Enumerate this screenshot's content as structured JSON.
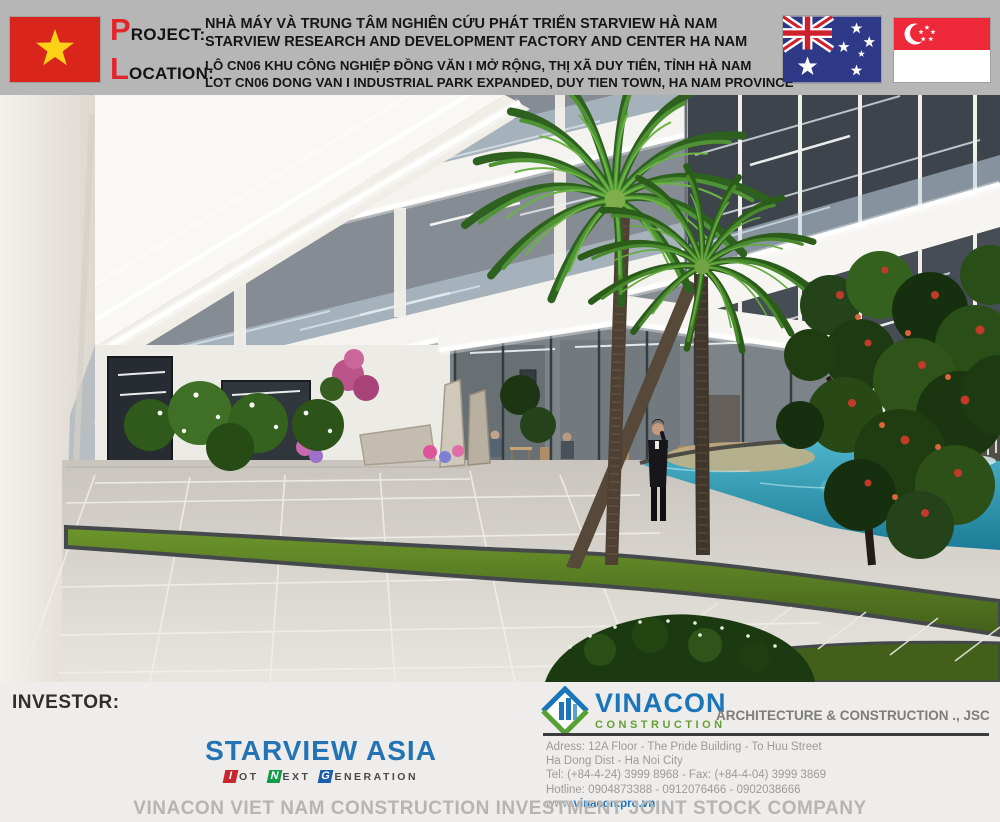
{
  "header": {
    "project": {
      "initial": "P",
      "rest": "ROJECT:",
      "line_vi": "NHÀ MÁY VÀ TRUNG TÂM NGHIÊN CỨU PHÁT TRIỂN STARVIEW HÀ NAM",
      "line_en": "STARVIEW RESEARCH AND DEVELOPMENT FACTORY AND CENTER HA NAM"
    },
    "location": {
      "initial": "L",
      "rest": "OCATION:",
      "line_vi": "LÔ CN06 KHU CÔNG NGHIỆP ĐỒNG VĂN I MỞ RỘNG, THỊ XÃ DUY TIÊN, TỈNH HÀ NAM",
      "line_en": "LOT CN06 DONG VAN I INDUSTRIAL PARK EXPANDED, DUY TIEN TOWN, HA NAM PROVINCE"
    },
    "flags": [
      "vietnam",
      "australia",
      "singapore"
    ]
  },
  "footer": {
    "investor_label": "INVESTOR:",
    "starview": {
      "name": "STARVIEW ASIA",
      "tagline": [
        {
          "initial": "I",
          "rest": "OT"
        },
        {
          "initial": "N",
          "rest": "EXT"
        },
        {
          "initial": "G",
          "rest": "ENERATION"
        }
      ]
    },
    "vinacon": {
      "name": "VINACON",
      "sub": "CONSTRUCTION",
      "type": "ARCHITECTURE & CONSTRUCTION ., JSC",
      "address1": "Adress: 12A Floor - The Pride Building - To Huu Street",
      "address2": "Ha Dong Dist - Ha Noi City",
      "tel": "Tel: (+84-4-24) 3999 8968 - Fax: (+84-4-04) 3999 3869",
      "hotline": "Hotline: 0904873388 - 0912076466 - 0902038666",
      "web_prefix": "www.",
      "web_link": "vinacon.pro.vn"
    },
    "company_name": "VINACON VIET NAM CONSTRUCTION INVESTMENT JOINT STOCK COMPANY"
  },
  "colors": {
    "accent_red": "#e5252c",
    "starview_blue": "#2474b5",
    "vinacon_blue": "#1b75bb",
    "vinacon_green": "#64a033",
    "header_gray": "#b6b6b6",
    "pool_teal": "#2f93ad"
  }
}
